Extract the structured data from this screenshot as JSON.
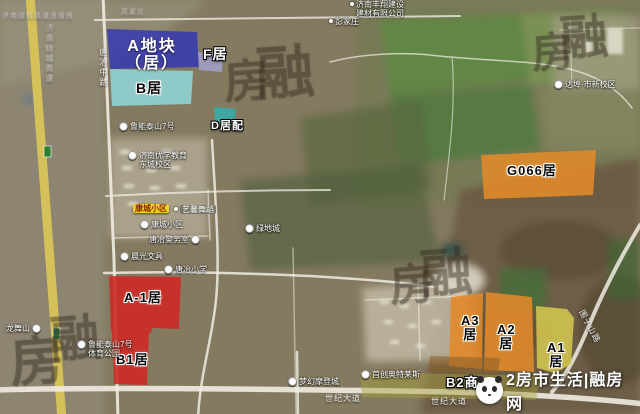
{
  "colors": {
    "parcel_blue": "#3538b2",
    "parcel_lavender": "#a9aadf",
    "parcel_cyan": "#8fd9da",
    "parcel_teal": "#2fb2b2",
    "parcel_orange": "#e0892a",
    "parcel_red": "#cd2a26",
    "parcel_yellow": "#d6c94f",
    "parcel_olive": "#a9a03c",
    "parcel_brown": "#8d5f28",
    "highway_yellow": "#d9c457"
  },
  "parcels": {
    "a_block": {
      "label": "A地块（居）"
    },
    "f": {
      "label": "F居"
    },
    "b": {
      "label": "B居"
    },
    "d": {
      "label": "D居配"
    },
    "g066": {
      "label": "G066居"
    },
    "a1_red": {
      "label": "A-1居"
    },
    "b1": {
      "label": "B1居"
    },
    "a3": {
      "label": "A3\n居"
    },
    "a2": {
      "label": "A2\n居"
    },
    "a1_yellow": {
      "label": "A1\n居"
    },
    "b2": {
      "label": "B2商"
    }
  },
  "pois": [
    {
      "label": "济南丰翔建设\n建材有限公司"
    },
    {
      "label": "彭家庄"
    },
    {
      "label": "达埠·市新校区"
    },
    {
      "label": "鲁能泰山7号"
    },
    {
      "label": "济南优学教育\n东城校区"
    },
    {
      "label": "康城小区"
    },
    {
      "label": "艺馨舞蹈"
    },
    {
      "label": "康城小区"
    },
    {
      "label": "唐冶警务室"
    },
    {
      "label": "绿地城"
    },
    {
      "label": "晨光文具"
    },
    {
      "label": "唐冶小学"
    },
    {
      "label": "龙舞山"
    },
    {
      "label": "鲁能泰山7号\n体育公园"
    },
    {
      "label": "梦幻摩登城"
    },
    {
      "label": "首创奥特莱斯"
    }
  ],
  "road_labels": [
    {
      "label": "世纪大道"
    },
    {
      "label": "世纪大道"
    },
    {
      "label": "唐冶中路"
    },
    {
      "label": "济南绕城高速"
    },
    {
      "label": "围子山路"
    },
    {
      "label": "济南绕城高速连接线"
    },
    {
      "label": "高家庄"
    }
  ],
  "seal_watermarks": [
    "房",
    "融",
    "房",
    "融",
    "房",
    "融",
    "融",
    "房"
  ],
  "watermark": {
    "logo": "panda-logo",
    "text": "2房市生活|融房网"
  }
}
